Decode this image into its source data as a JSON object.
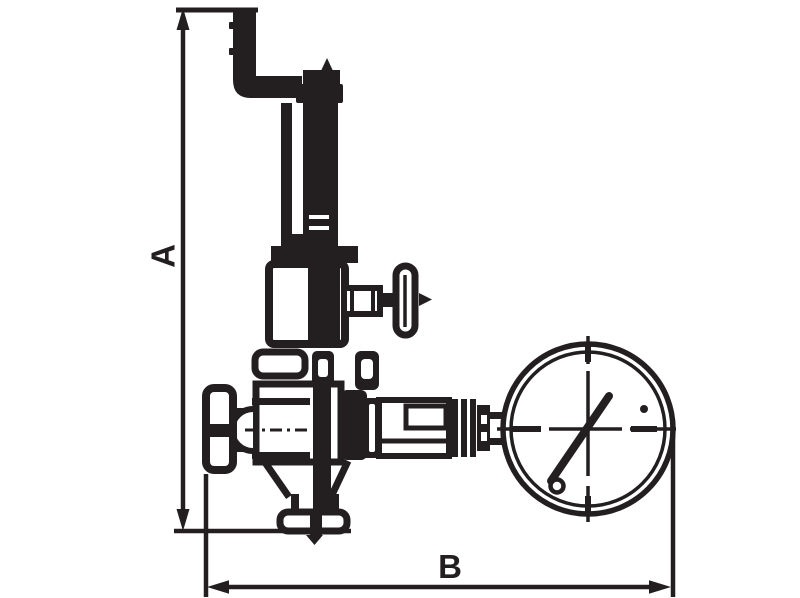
{
  "drawing": {
    "title": "valve-with-gauge-dimension-drawing",
    "labels": {
      "dimension_a": "A",
      "dimension_b": "B"
    },
    "colors": {
      "ink": "#231f20",
      "background": "#ffffff"
    }
  }
}
